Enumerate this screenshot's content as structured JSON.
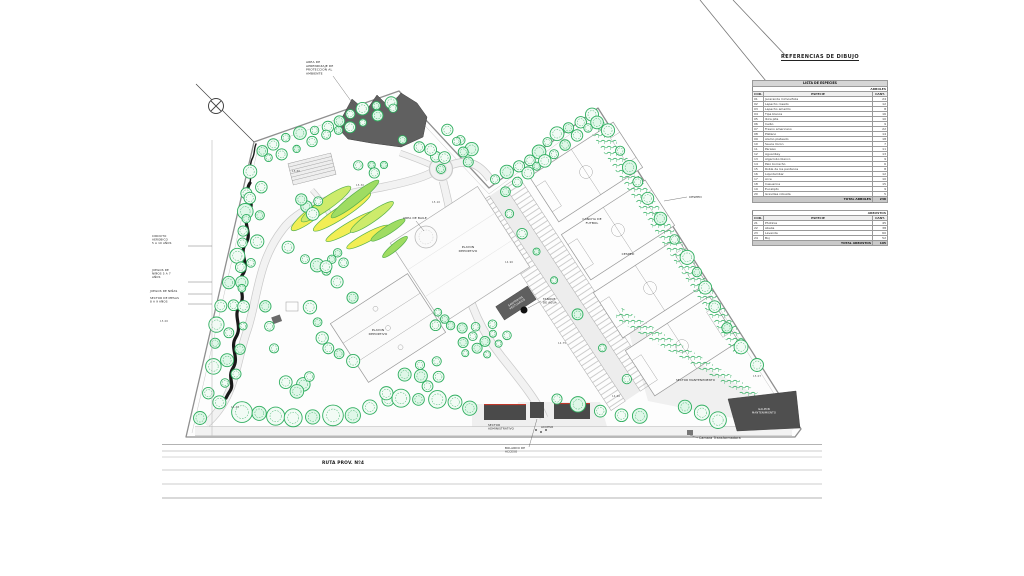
{
  "legend": {
    "title": "REFERENCIAS DE DIBUJO",
    "table_trees": {
      "band": "LISTA DE ESPECIES",
      "group": "ARBOLES",
      "columns": [
        "COD.",
        "ESPECIE",
        "CANT."
      ],
      "rows": [
        [
          "01",
          "Jacaranda mimosifolia",
          "24"
        ],
        [
          "02",
          "Lapacho rosado",
          "12"
        ],
        [
          "03",
          "Lapacho amarillo",
          "8"
        ],
        [
          "04",
          "Tipa blanca",
          "16"
        ],
        [
          "05",
          "Ibira pita",
          "10"
        ],
        [
          "06",
          "Ceibo",
          "9"
        ],
        [
          "07",
          "Fresno americano",
          "22"
        ],
        [
          "08",
          "Platano",
          "14"
        ],
        [
          "09",
          "Alamo plateado",
          "18"
        ],
        [
          "10",
          "Sauce lloron",
          "7"
        ],
        [
          "11",
          "Paraiso",
          "11"
        ],
        [
          "12",
          "Aguaribay",
          "13"
        ],
        [
          "13",
          "Algarrobo blanco",
          "9"
        ],
        [
          "14",
          "Palo borracho",
          "6"
        ],
        [
          "15",
          "Roble de los pantanos",
          "8"
        ],
        [
          "16",
          "Liquidambar",
          "12"
        ],
        [
          "17",
          "Arce",
          "10"
        ],
        [
          "18",
          "Casuarina",
          "15"
        ],
        [
          "19",
          "Eucalipto",
          "9"
        ],
        [
          "20",
          "Grevillea robusta",
          "5"
        ]
      ],
      "total_label": "TOTAL ARBOLES",
      "total": "238"
    },
    "table_shrubs": {
      "group": "ARBUSTOS",
      "columns": [
        "COD.",
        "ESPECIE",
        "CANT."
      ],
      "rows": [
        [
          "21",
          "Photinia",
          "45"
        ],
        [
          "22",
          "Abelia",
          "38"
        ],
        [
          "23",
          "Lavanda",
          "60"
        ],
        [
          "24",
          "Boj",
          "52"
        ]
      ],
      "total_label": "TOTAL ARBUSTOS",
      "total": "195"
    }
  },
  "plan": {
    "colors": {
      "tree_green": "#2fae5f",
      "bed_yellow": "#f2ee55",
      "building_gray": "#5f5f5f",
      "accent_red": "#c0392b"
    },
    "labels": [
      {
        "n": "label-area-aprendizaje",
        "x": 306,
        "y": 63,
        "s": 3,
        "t": [
          "AREA DE",
          "APRENDIZAJE DE",
          "PROTECCION AL",
          "AMBIENTE"
        ]
      },
      {
        "n": "label-circuito-aerobico",
        "x": 152,
        "y": 237,
        "s": 2.8,
        "t": [
          "CIRCUITO",
          "AEROBICO",
          "5 A 10 AÑOS"
        ]
      },
      {
        "n": "label-juegos-5-7",
        "x": 152,
        "y": 271,
        "s": 2.8,
        "t": [
          "JUEGOS DE",
          "NIÑOS 5 A 7",
          "AÑOS"
        ]
      },
      {
        "n": "label-juegos-ninas",
        "x": 150,
        "y": 292,
        "s": 2.8,
        "t": [
          "JUEGOS DE NIÑAS"
        ]
      },
      {
        "n": "label-sector-mesas",
        "x": 150,
        "y": 299,
        "s": 2.8,
        "t": [
          "SECTOR DE MESAS",
          "8 A 9 AÑOS"
        ]
      },
      {
        "n": "label-area-baile",
        "x": 403,
        "y": 219,
        "s": 2.9,
        "t": [
          "AREA DE BAILE"
        ]
      },
      {
        "n": "label-playon-deportivo-1",
        "x": 468,
        "y": 248,
        "s": 3,
        "a": "middle",
        "t": [
          "PLAYON",
          "DEPORTIVO"
        ]
      },
      {
        "n": "label-playon-deportivo-2",
        "x": 378,
        "y": 331,
        "s": 3,
        "a": "middle",
        "t": [
          "PLAYON",
          "DEPORTIVO"
        ]
      },
      {
        "n": "label-cancha-futbol",
        "x": 592,
        "y": 220,
        "s": 3,
        "a": "middle",
        "t": [
          "CANCHA DE",
          "FUTBOL"
        ]
      },
      {
        "n": "label-cesped-1",
        "x": 689,
        "y": 198,
        "s": 3,
        "t": [
          "CESPED"
        ]
      },
      {
        "n": "label-cesped-2",
        "x": 628,
        "y": 255,
        "s": 3,
        "a": "middle",
        "t": [
          "CESPED"
        ]
      },
      {
        "n": "label-tanque-agua",
        "x": 543,
        "y": 300,
        "s": 2.8,
        "t": [
          "TANQUE",
          "DE AGUA"
        ]
      },
      {
        "n": "label-sanitarios",
        "x": 516,
        "y": 302,
        "s": 2.6,
        "a": "middle",
        "c": "#ffffff",
        "r": -33,
        "t": [
          "SANITARIOS",
          "VESTUARIOS"
        ]
      },
      {
        "n": "label-sector-administrativo",
        "x": 488,
        "y": 426,
        "s": 2.8,
        "t": [
          "SECTOR",
          "ADMINISTRATIVO"
        ]
      },
      {
        "n": "label-bolardo-acceso",
        "x": 505,
        "y": 449,
        "s": 2.8,
        "t": [
          "BOLARDO DE",
          "ACCESO"
        ]
      },
      {
        "n": "label-acceso",
        "x": 541,
        "y": 428,
        "s": 2.8,
        "t": [
          "ACCESO"
        ]
      },
      {
        "n": "label-sector-mantenimiento",
        "x": 676,
        "y": 381,
        "s": 2.8,
        "t": [
          "SECTOR MANTENIMIENTO"
        ]
      },
      {
        "n": "label-galpon-mantenimiento",
        "x": 764,
        "y": 410,
        "s": 2.6,
        "a": "middle",
        "c": "#ffffff",
        "t": [
          "GALPON",
          "MANTENIMIENTO"
        ]
      },
      {
        "n": "label-camara-transformadora",
        "x": 699,
        "y": 439,
        "s": 3.2,
        "t": [
          "Camara Transformadora"
        ]
      },
      {
        "n": "label-ruta-prov",
        "x": 322,
        "y": 464,
        "s": 4.4,
        "w": 1,
        "t": [
          "RUTA PROV. Nº4"
        ]
      },
      {
        "n": "label-cota-1",
        "x": 356,
        "y": 186,
        "s": 2.6,
        "c": "#555555",
        "t": [
          "15.30"
        ]
      },
      {
        "n": "label-cota-2",
        "x": 432,
        "y": 203,
        "s": 2.6,
        "c": "#555555",
        "t": [
          "15.10"
        ]
      },
      {
        "n": "label-cota-3",
        "x": 505,
        "y": 263,
        "s": 2.6,
        "c": "#555555",
        "t": [
          "14.90"
        ]
      },
      {
        "n": "label-cota-4",
        "x": 558,
        "y": 344,
        "s": 2.6,
        "c": "#555555",
        "t": [
          "14.75"
        ]
      },
      {
        "n": "label-cota-5",
        "x": 612,
        "y": 397,
        "s": 2.6,
        "c": "#555555",
        "t": [
          "14.60"
        ]
      },
      {
        "n": "label-cota-6",
        "x": 753,
        "y": 377,
        "s": 2.6,
        "c": "#555555",
        "t": [
          "15.07"
        ]
      },
      {
        "n": "label-cota-7",
        "x": 231,
        "y": 408,
        "s": 2.6,
        "c": "#555555",
        "t": [
          "15.45"
        ]
      },
      {
        "n": "label-cota-8",
        "x": 160,
        "y": 322,
        "s": 2.6,
        "c": "#555555",
        "t": [
          "15.00"
        ]
      },
      {
        "n": "label-cota-9",
        "x": 292,
        "y": 172,
        "s": 2.6,
        "c": "#555555",
        "t": [
          "15.60"
        ]
      }
    ]
  }
}
